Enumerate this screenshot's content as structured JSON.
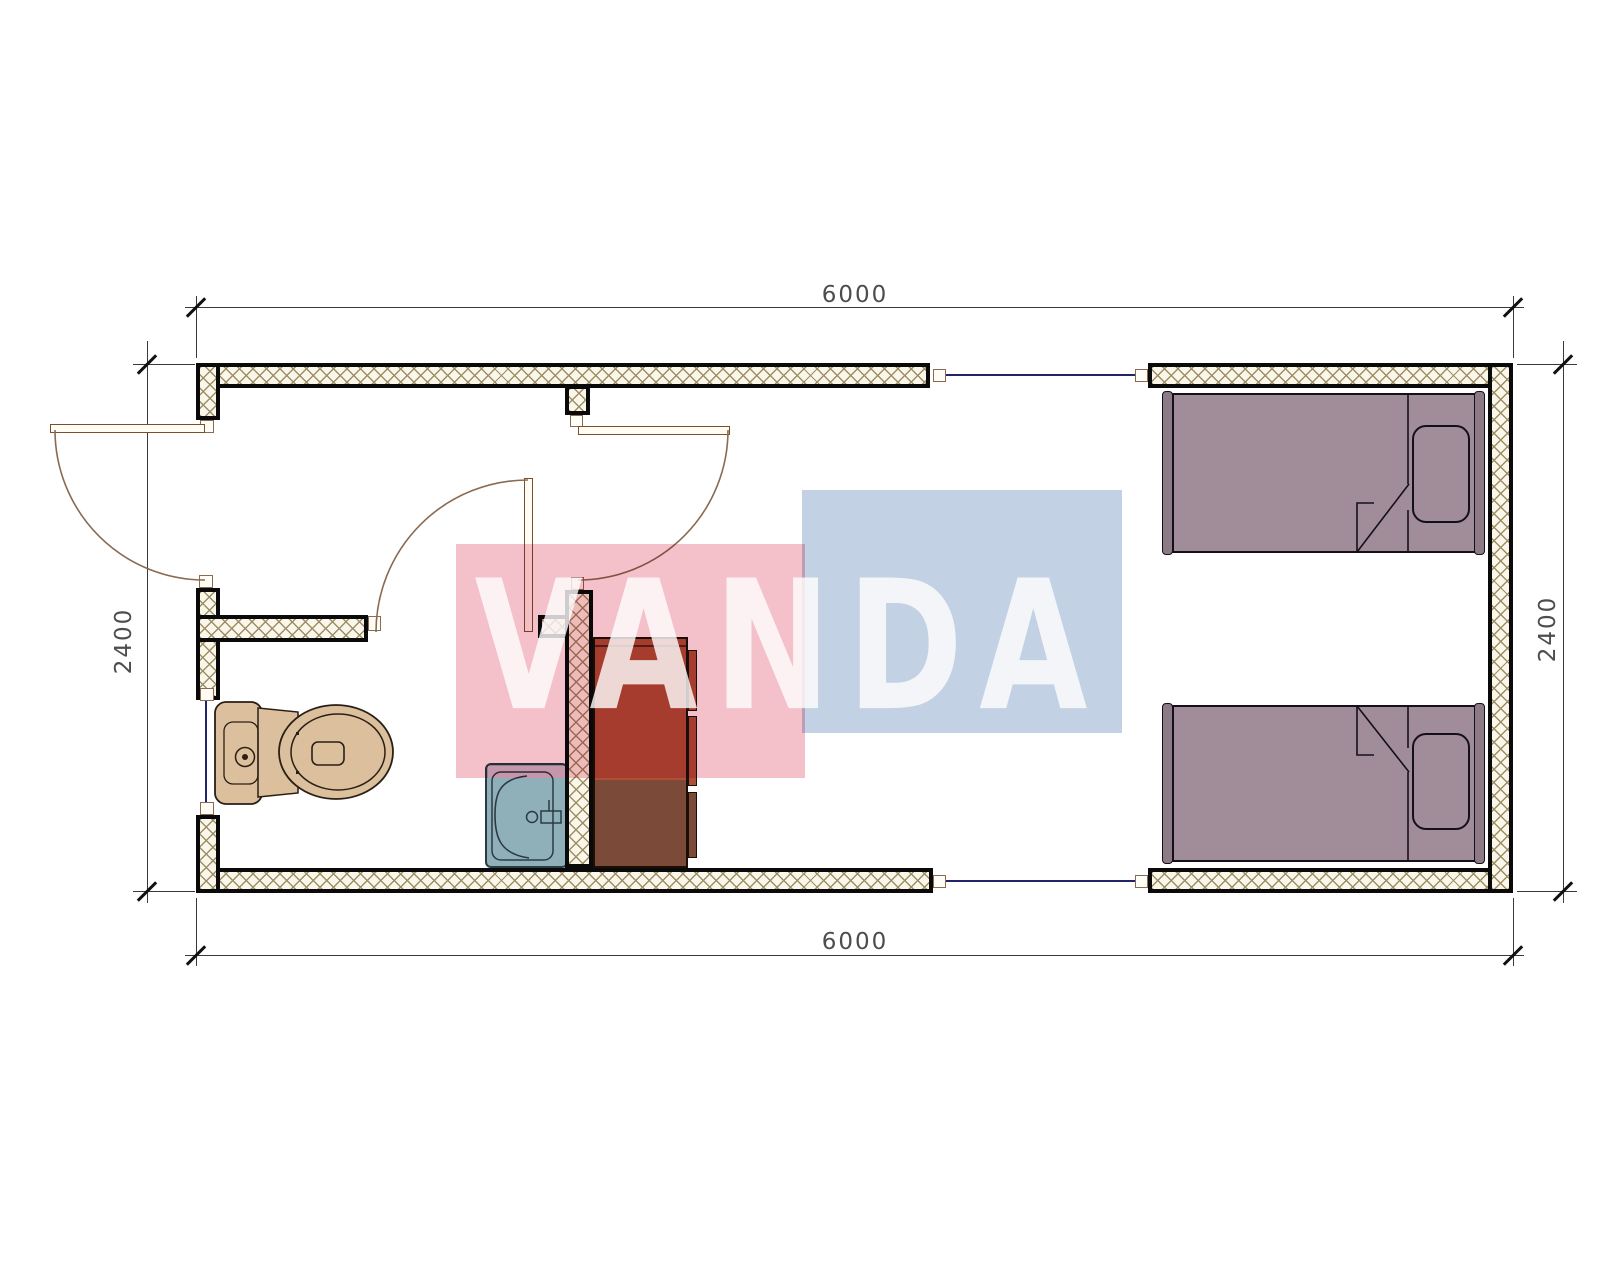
{
  "title": "container house floor plan",
  "dimensions": {
    "top": "6000",
    "bottom": "6000",
    "left": "2400",
    "right": "2400"
  },
  "watermark": {
    "text": "VANDA"
  },
  "colors": {
    "wall-line": "#0a0a0a",
    "hatch-bg": "#faf6ea",
    "hatch-line": "#9c8e66",
    "door": "#7a4f2e",
    "arc": "#8a6a50",
    "window": "#23236b",
    "dim-line": "#3a3a3a",
    "dim-text": "#4d4d4d",
    "toilet": "#dcc09e",
    "toilet-line": "#2a1f14",
    "sink": "#8fb0b8",
    "sink-line": "#2c3a42",
    "sink-band": "#cfc8d8",
    "cabinet-top": "#ae4f38",
    "cabinet-bottom": "#7c4a38",
    "cabinet-line": "#1a1008",
    "bed": "#a18d99",
    "bed-rail": "#8d7a87",
    "bed-line": "#14101a",
    "wm-pink": "#f4c1cb",
    "wm-blue": "#c3d1e4",
    "wm-text": "#ffffff"
  }
}
